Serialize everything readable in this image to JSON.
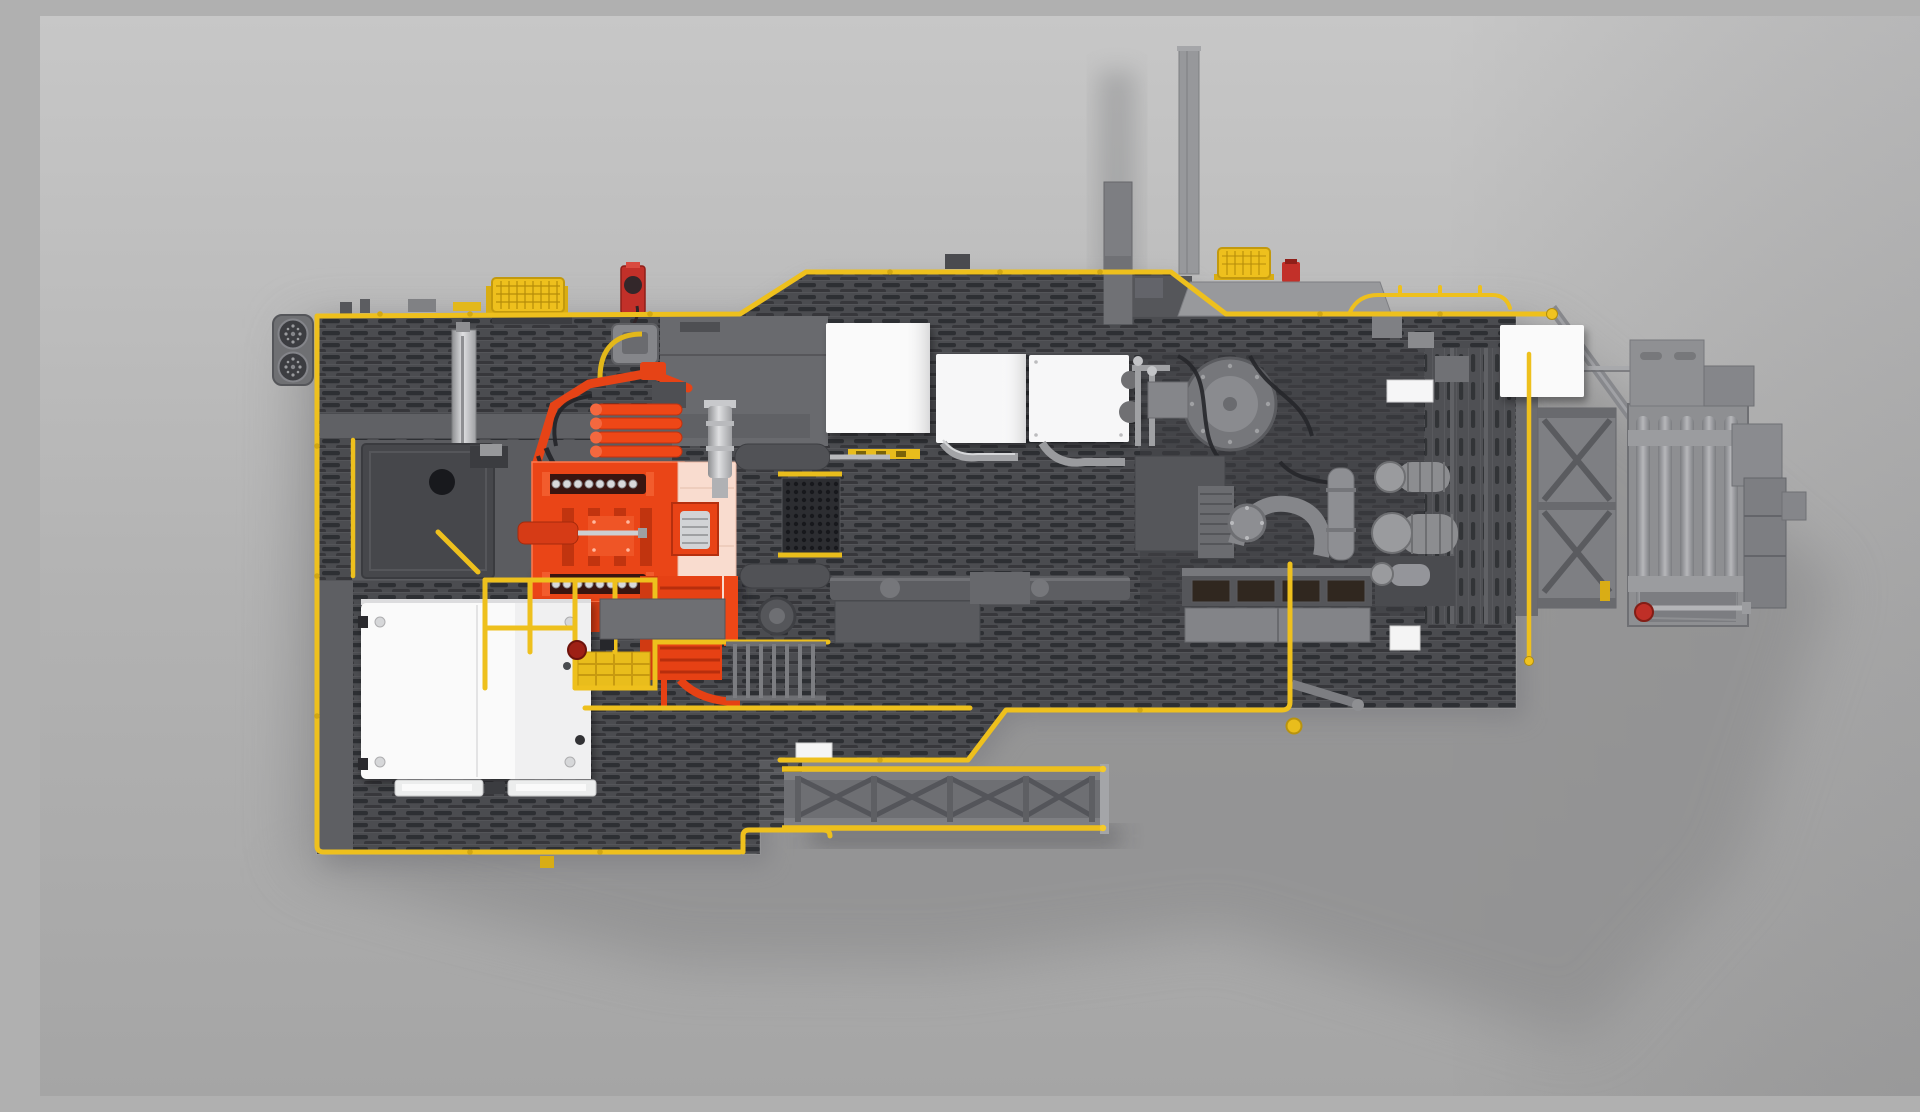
{
  "scene": {
    "description": "Top-down CGI rendering of an industrial coiled-tubing drilling rig trailer deck with safety-yellow railings, an orange injector head unit, white equipment enclosures, gray engine and pump machinery, a truss catwalk gangway and a gooseneck roller frame, on a plain gray studio background with a soft shadow.",
    "view": "top-down orthographic product render",
    "canvas": {
      "width_px": 1920,
      "height_px": 1080
    },
    "caption": "Top view 3D rendering of a drilling / coiled tubing rig trailer deck"
  },
  "palette": {
    "background_top": "#c6c6c6",
    "background_bottom": "#a6a6a6",
    "shadow_gray": "#8f8f90",
    "deck_gray": "#4b4c50",
    "grating_dark": "#2e2f33",
    "panel_gray": "#696a6e",
    "platform_gray": "#5b5c60",
    "steel_silver": "#a8a9ac",
    "safety_yellow": "#eec01d",
    "yellow_dark": "#c2990e",
    "machine_orange": "#ea4517",
    "orange_dark": "#c03210",
    "injector_pink": "#f9dccf",
    "alert_red": "#c23029",
    "enclosure_white": "#fafafa",
    "hose_black": "#26272b"
  },
  "components": [
    {
      "id": "fan-pod",
      "label": "Twin circular fan pod",
      "color": "#6f7073",
      "location": "far left edge of upper deck"
    },
    {
      "id": "upper-deck",
      "label": "Grated upper deck strip",
      "color": "#4b4c50",
      "location": "upper left"
    },
    {
      "id": "hose-basket-left",
      "label": "Yellow caged hose basket",
      "color": "#eec01d",
      "location": "top left railing"
    },
    {
      "id": "hose-basket-right",
      "label": "Yellow caged hose basket",
      "color": "#eec01d",
      "location": "top right railing"
    },
    {
      "id": "red-hose-reel",
      "label": "Red hose reel",
      "color": "#c23029",
      "location": "top, left of center"
    },
    {
      "id": "exhaust-stack-tall",
      "label": "Tall thin exhaust stack",
      "color": "#97989b",
      "location": "top center"
    },
    {
      "id": "exhaust-stack-wide",
      "label": "Wide exhaust stack",
      "color": "#7d7e82",
      "location": "top center"
    },
    {
      "id": "white-boxes",
      "label": "Three white equipment enclosures",
      "color": "#fafafa",
      "location": "top center deck"
    },
    {
      "id": "injector-head",
      "label": "Orange injector head with twin chain drives and hydraulic links",
      "color": "#ea4517",
      "location": "center left"
    },
    {
      "id": "injector-pink-box",
      "label": "Pale pink lubricator box with cable spool",
      "color": "#f9dccf",
      "location": "right side of injector"
    },
    {
      "id": "hydraulic-mast",
      "label": "Silver hydraulic mast cylinder",
      "color": "#c6c7ca",
      "location": "upper left deck"
    },
    {
      "id": "deck-hatch",
      "label": "Dark access hatch with round port",
      "color": "#46474b",
      "location": "mid left platform"
    },
    {
      "id": "cabin-roof",
      "label": "White control cabin roof with corner hinges",
      "color": "#fcfcfc",
      "location": "lower left"
    },
    {
      "id": "stair-platform",
      "label": "Yellow stair railing and grated step platform with red E-stop",
      "color": "#eec01d",
      "location": "right of cabin"
    },
    {
      "id": "access-ladder",
      "label": "Gray rung ladder",
      "color": "#6f7074",
      "location": "lower center deck"
    },
    {
      "id": "engine-hood",
      "label": "Light gray engine hood panel",
      "color": "#98999c",
      "location": "top right of center"
    },
    {
      "id": "flywheel-pump",
      "label": "Large circular flanged flywheel pump",
      "color": "#76777b",
      "location": "engine bay"
    },
    {
      "id": "radiator",
      "label": "Radiator core with dark mesh segments",
      "color": "#55565a",
      "location": "engine bay bottom"
    },
    {
      "id": "twin-pumps",
      "label": "Twin ribbed cylindrical pumps",
      "color": "#8c8d90",
      "location": "right engine bay"
    },
    {
      "id": "cooler-grille",
      "label": "Vertical-slot cooler grille",
      "color": "#4f5054",
      "location": "right end of deck"
    },
    {
      "id": "white-box-right",
      "label": "White enclosure at deck right edge",
      "color": "#fafafa",
      "location": "top right"
    },
    {
      "id": "catwalk-gangway",
      "label": "Truss catwalk gangway with X-bracing and yellow handrails",
      "color": "#6e6f73",
      "location": "bottom center, extending right"
    },
    {
      "id": "gooseneck-frame",
      "label": "X-braced gooseneck trailer frame",
      "color": "#7e7f83",
      "location": "right of deck"
    },
    {
      "id": "roller-assembly",
      "label": "Vertical roller guide assembly",
      "color": "#8e8f92",
      "location": "far right"
    },
    {
      "id": "outrigger-arm",
      "label": "Small outrigger arm with yellow pad",
      "color": "#7d7e82",
      "location": "bottom right corner of deck"
    },
    {
      "id": "red-knob",
      "label": "Red valve knob with silver rod",
      "color": "#bf2f27",
      "location": "far right bottom"
    },
    {
      "id": "perimeter-railing",
      "label": "Safety-yellow perimeter handrails and pipes",
      "color": "#eec01d",
      "location": "all deck edges"
    }
  ]
}
